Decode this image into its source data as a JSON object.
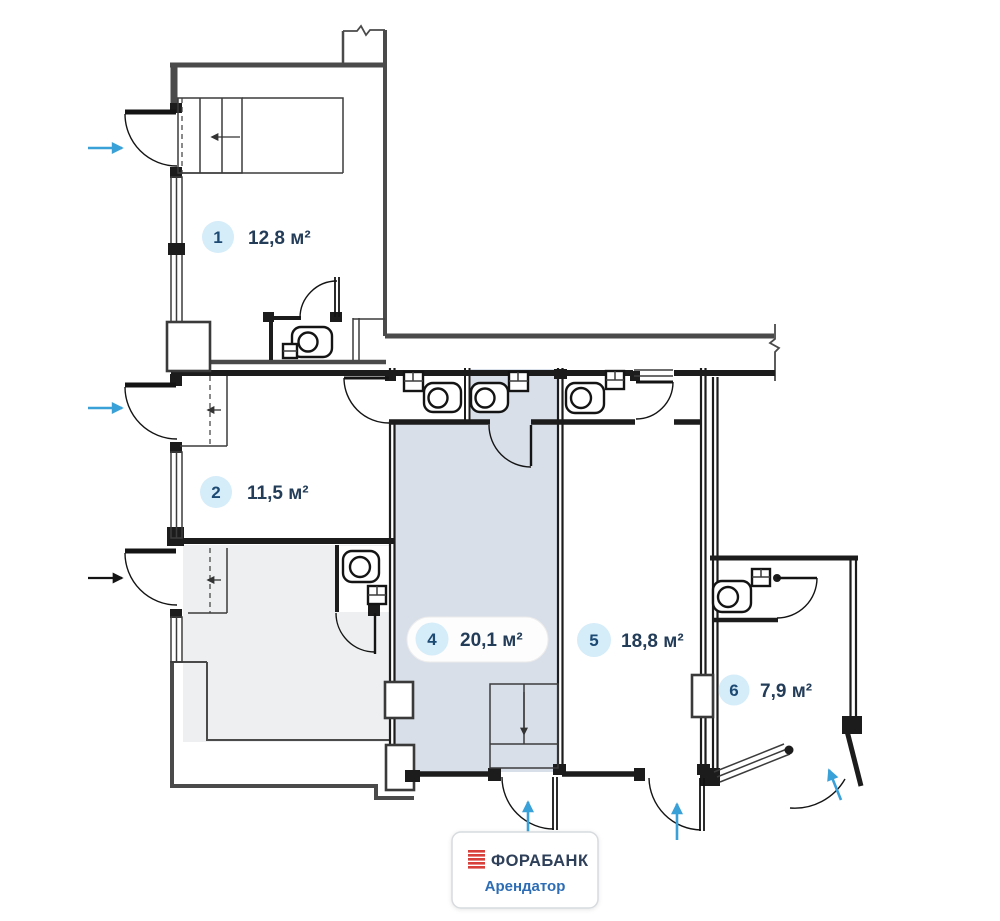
{
  "rooms": [
    {
      "number": "1",
      "area": "12,8 м²"
    },
    {
      "number": "2",
      "area": "11,5 м²"
    },
    {
      "number": "4",
      "area": "20,1 м²"
    },
    {
      "number": "5",
      "area": "18,8 м²"
    },
    {
      "number": "6",
      "area": "7,9 м²"
    }
  ],
  "tenant_badge": {
    "bank": "ФОРАБАНК",
    "label": "Арендатор"
  },
  "colors": {
    "wall-gray": "#4a4a4a",
    "partition-black": "#1c1c1c",
    "arrow-blue": "#3aa0d8",
    "room4-fill": "#d8dfe9",
    "room3-fill": "#edeff0",
    "chip-fill": "#d5ecf9",
    "chip-text": "#1d4a73",
    "area-text": "#233c58",
    "bank-red": "#d8403c",
    "bank-text": "#2e3f59",
    "tenant-text": "#2d6db5",
    "badge-border": "#d7dbde"
  }
}
